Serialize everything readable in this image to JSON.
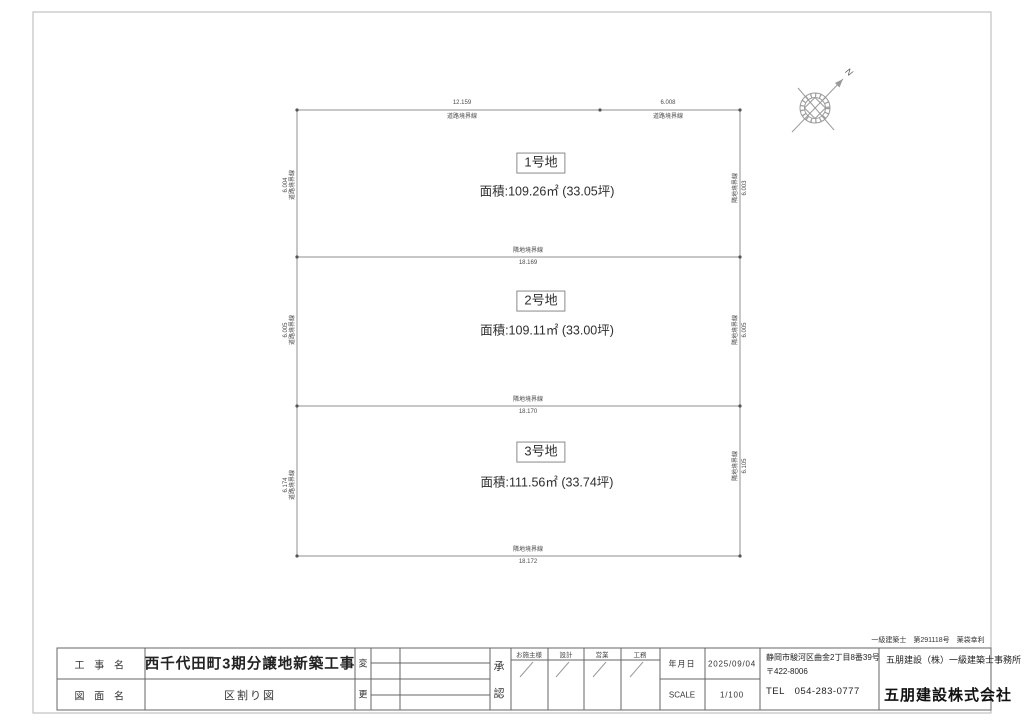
{
  "plan": {
    "north_label": "N",
    "top_dimensions": [
      {
        "value": "12.159",
        "label": "道路境界線"
      },
      {
        "value": "6.008",
        "label": "道路境界線"
      }
    ],
    "left_dimensions": [
      {
        "value": "6.004",
        "label": "道路境界線"
      },
      {
        "value": "6.005",
        "label": "道路境界線"
      },
      {
        "value": "6.174",
        "label": "道路境界線"
      }
    ],
    "right_dimensions": [
      {
        "label": "隣地境界線",
        "value": "6.003"
      },
      {
        "label": "隣地境界線",
        "value": "6.005"
      },
      {
        "label": "隣地境界線",
        "value": "6.105"
      }
    ],
    "inner_boundaries": [
      {
        "label": "隣地境界線",
        "value": "18.169"
      },
      {
        "label": "隣地境界線",
        "value": "18.170"
      }
    ],
    "bottom_boundary": {
      "label": "隣地境界線",
      "value": "18.172"
    },
    "lots": [
      {
        "name": "1号地",
        "area": "面積:109.26㎡ (33.05坪)"
      },
      {
        "name": "2号地",
        "area": "面積:109.11㎡ (33.00坪)"
      },
      {
        "name": "3号地",
        "area": "面積:111.56㎡ (33.74坪)"
      }
    ]
  },
  "title_block": {
    "project_label": "工 事 名",
    "project_name": "西千代田町3期分譲地新築工事",
    "drawing_label": "図 面 名",
    "drawing_name": "区割り図",
    "revision_top": "変",
    "revision_bottom": "更",
    "approval_top": "承",
    "approval_bottom": "認",
    "signature_columns": [
      "お施主様",
      "設計",
      "営業",
      "工務"
    ],
    "date_label": "年月日",
    "date_value": "2025/09/04",
    "scale_label": "SCALE",
    "scale_value": "1/100",
    "address_line1": "静岡市駿河区曲金2丁目8番39号",
    "address_line2": "〒422-8006",
    "address_line3": "TEL　054-283-0777",
    "license_note": "一級建築士　第291118号　薬袋幸利",
    "office_name": "五朋建設（株）一級建築士事務所",
    "company_name": "五朋建設株式会社"
  }
}
